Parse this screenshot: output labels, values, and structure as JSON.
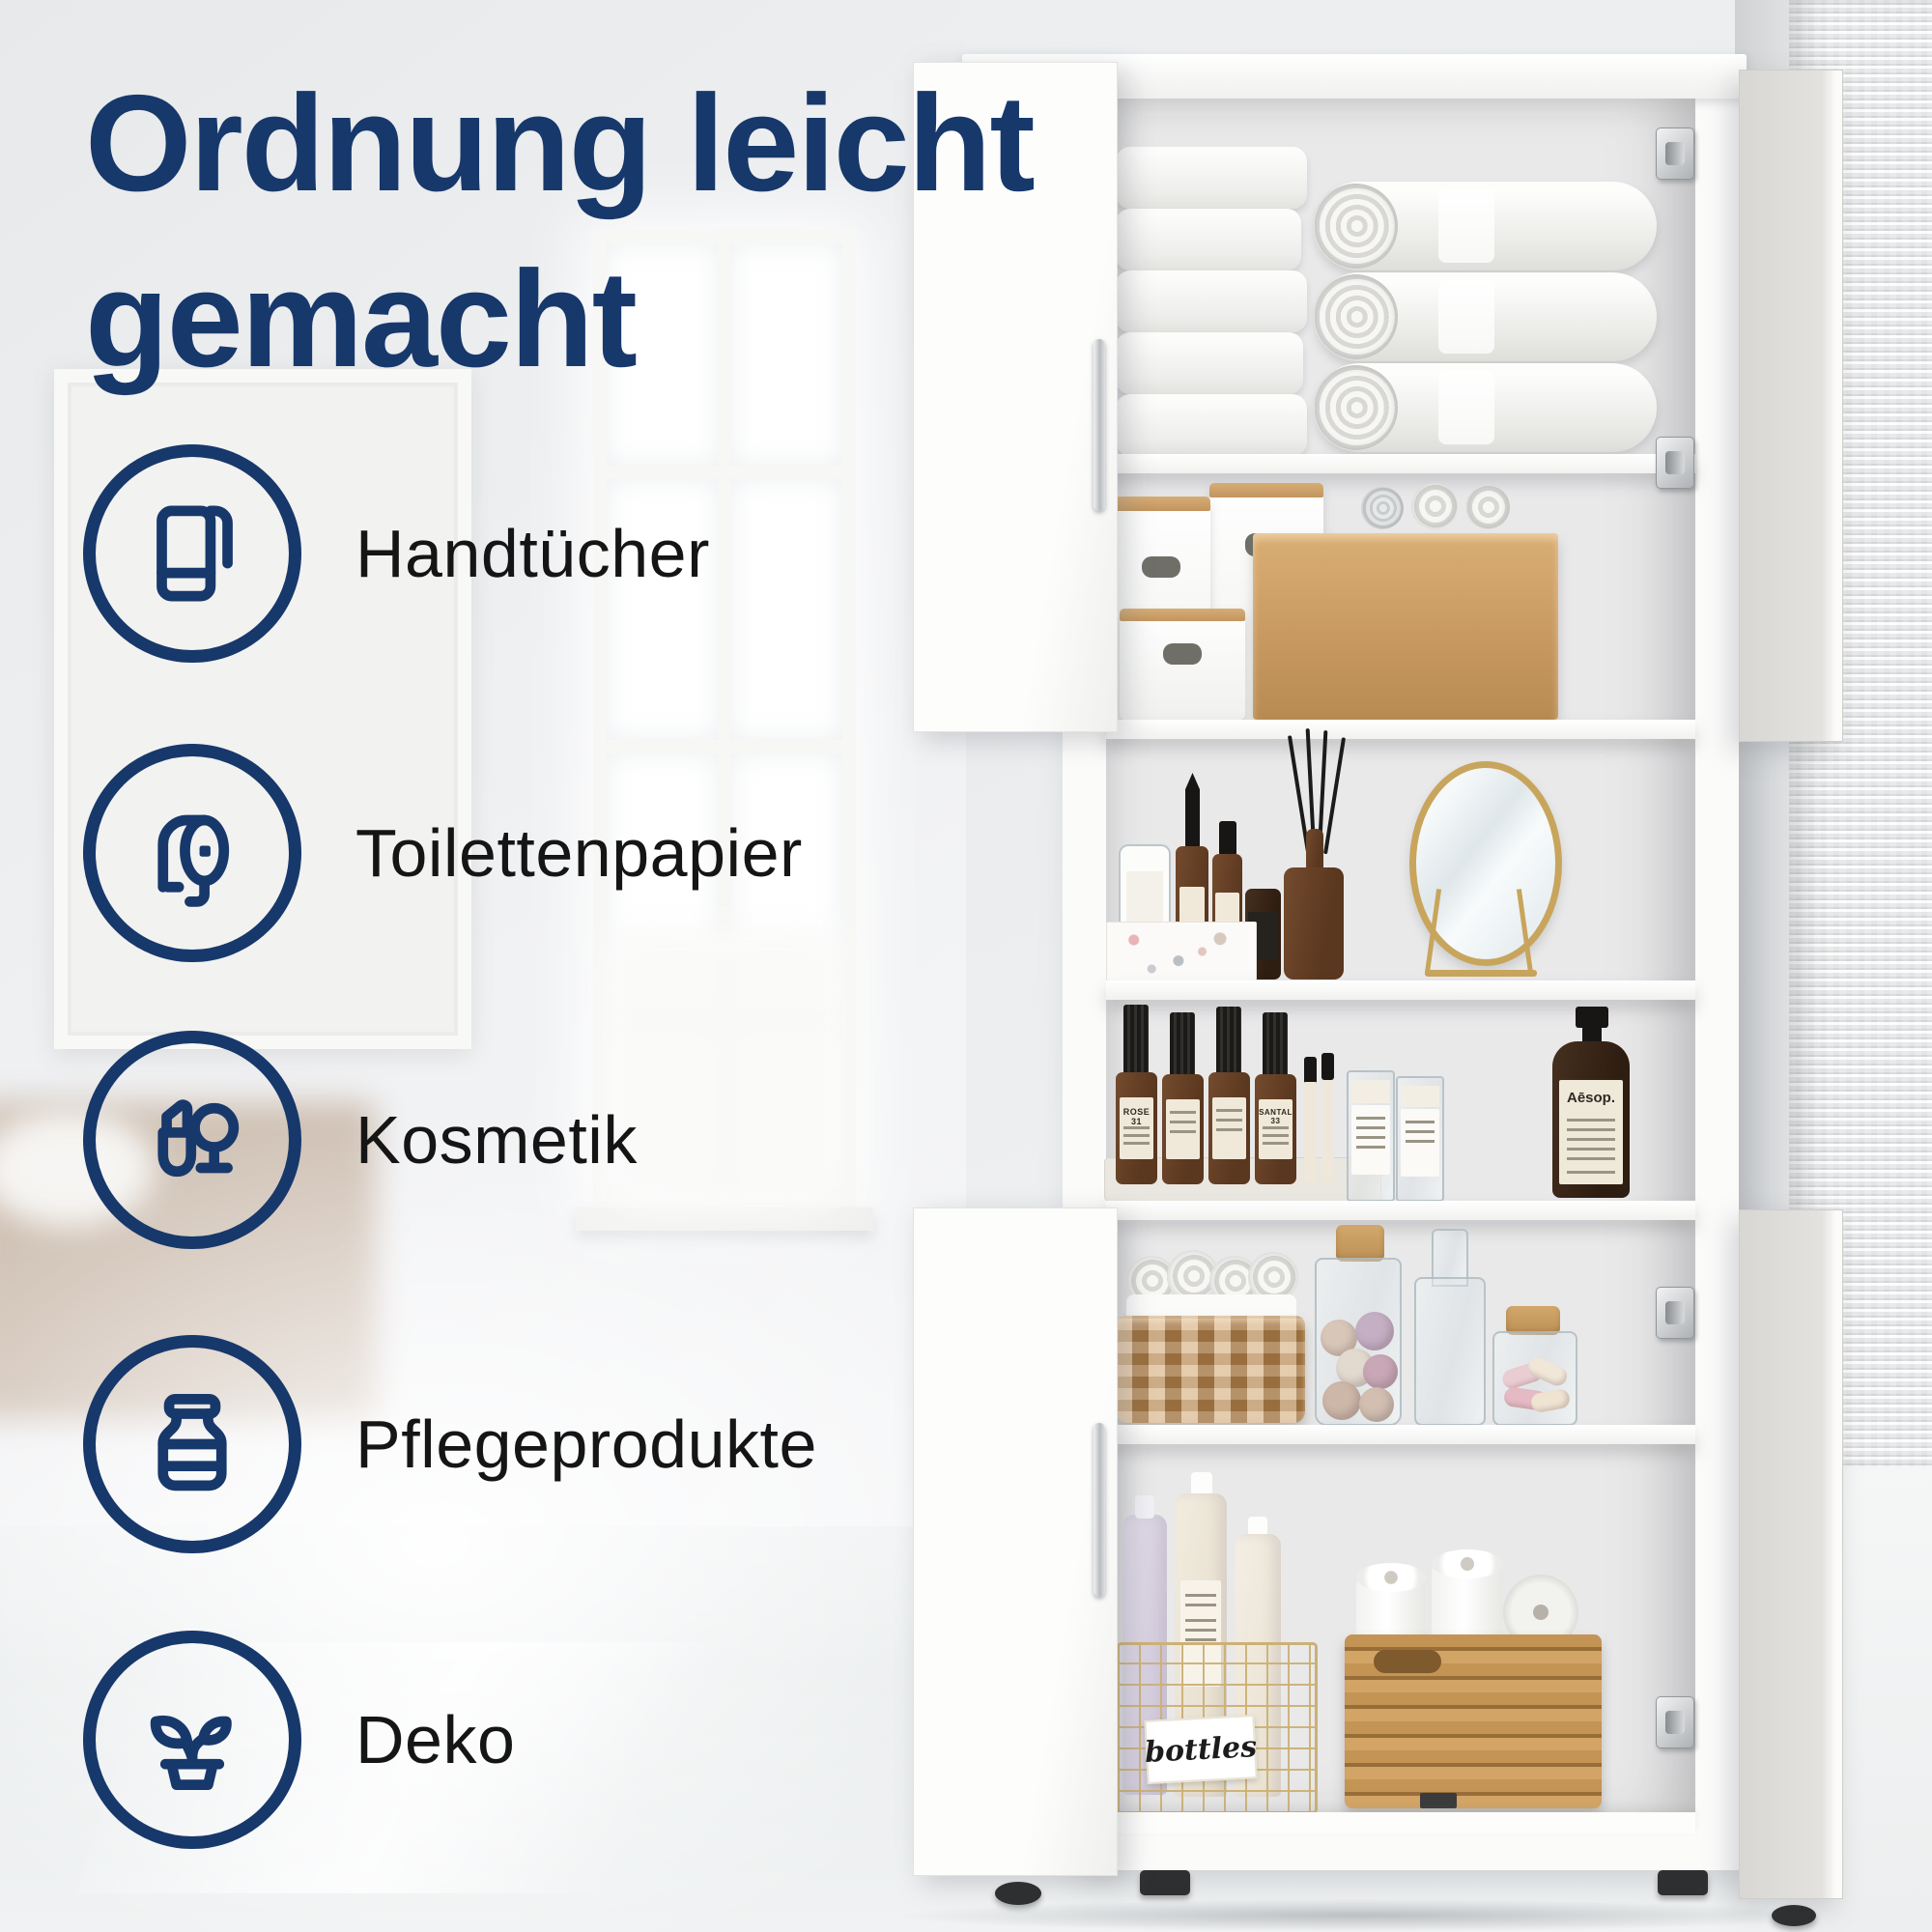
{
  "title": {
    "lines": [
      "Ordnung leicht",
      "gemacht"
    ]
  },
  "features": [
    {
      "id": "handtuecher",
      "label": "Handtücher",
      "icon": "towel-icon"
    },
    {
      "id": "toilettenpapier",
      "label": "Toilettenpapier",
      "icon": "toilet-paper-icon"
    },
    {
      "id": "kosmetik",
      "label": "Kosmetik",
      "icon": "cosmetics-icon"
    },
    {
      "id": "pflegeprodukte",
      "label": "Pflegeprodukte",
      "icon": "care-jar-icon"
    },
    {
      "id": "deko",
      "label": "Deko",
      "icon": "plant-icon"
    }
  ],
  "cabinet_photo": {
    "texts": {
      "tray_bottle_left_label": "ROSE 31",
      "tray_bottle_right_label": "SANTAL 33",
      "pump_bottle_label": "Aēsop.",
      "wire_basket_tag": "bottles"
    }
  },
  "colors": {
    "accent_navy": "#17386B",
    "label_text": "#151515",
    "wood": "#C79E66",
    "wicker": "#C2925A",
    "seagrass": "#BB8C50",
    "gold_wire": "#CBB176",
    "mirror_gold": "#C8A55C"
  }
}
